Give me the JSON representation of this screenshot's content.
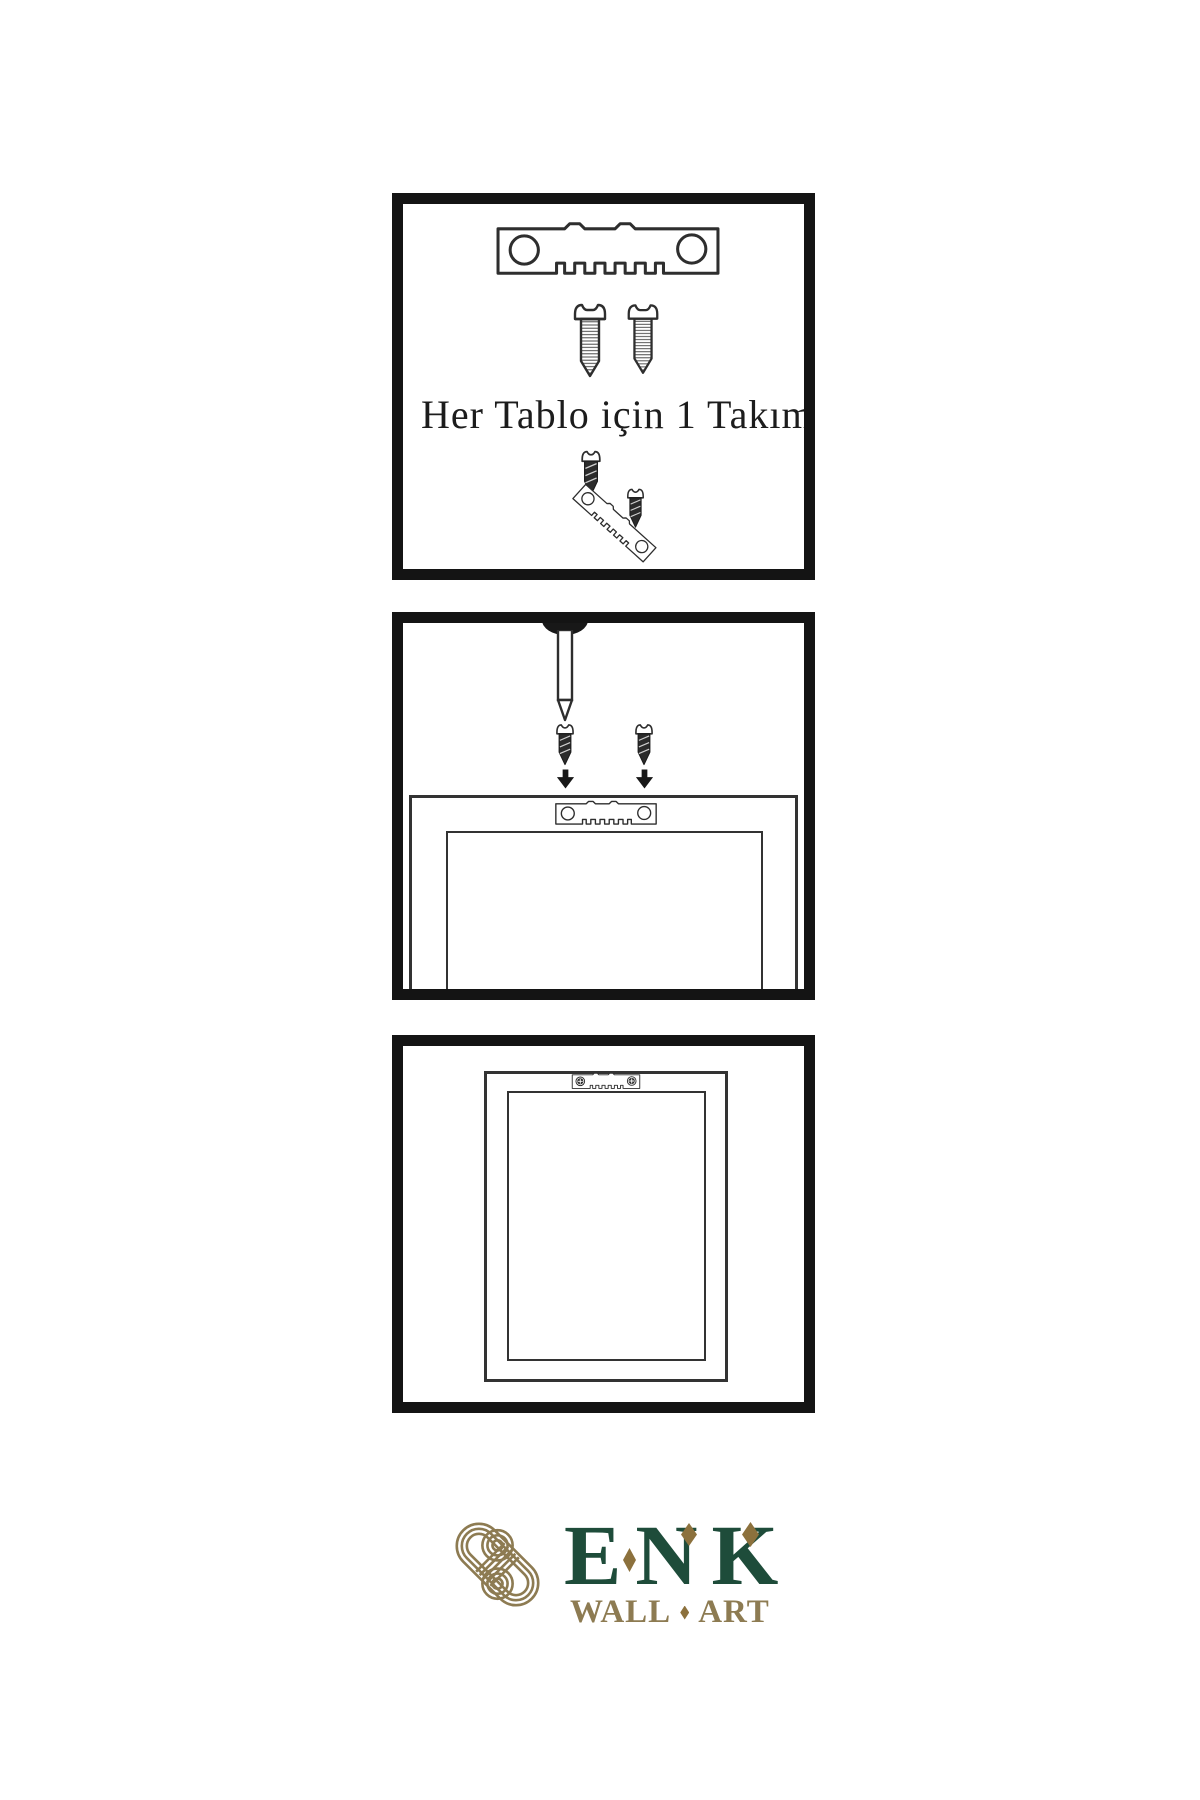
{
  "colors": {
    "panel_border": "#141414",
    "line": "#2e2e2e",
    "dark_fill": "#2b2b2b",
    "logo_green": "#1e4c3a",
    "logo_gold": "#8d7b52",
    "logo_gold_dark": "#8c713d"
  },
  "step1": {
    "caption": "Her Tablo için 1 Takım"
  },
  "logo": {
    "brand": "ENK",
    "tagline_word_1": "WALL",
    "tagline_word_2": "ART"
  }
}
